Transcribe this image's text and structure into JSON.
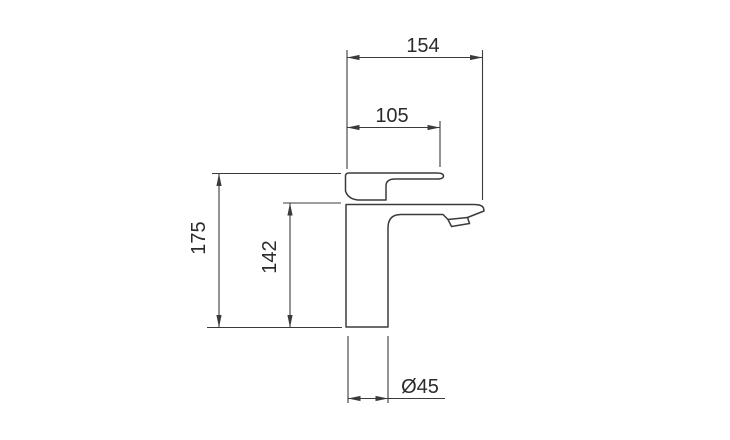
{
  "drawing": {
    "subject": "basin mixer faucet side elevation",
    "dimensions": {
      "overall_width": {
        "value": "154"
      },
      "top_width": {
        "value": "105"
      },
      "overall_height": {
        "value": "175"
      },
      "body_height": {
        "value": "142"
      },
      "base_diameter": {
        "value": "Ø45"
      }
    },
    "colors": {
      "line": "#3b3b3b",
      "text": "#2b2b2b",
      "background": "#ffffff"
    }
  }
}
